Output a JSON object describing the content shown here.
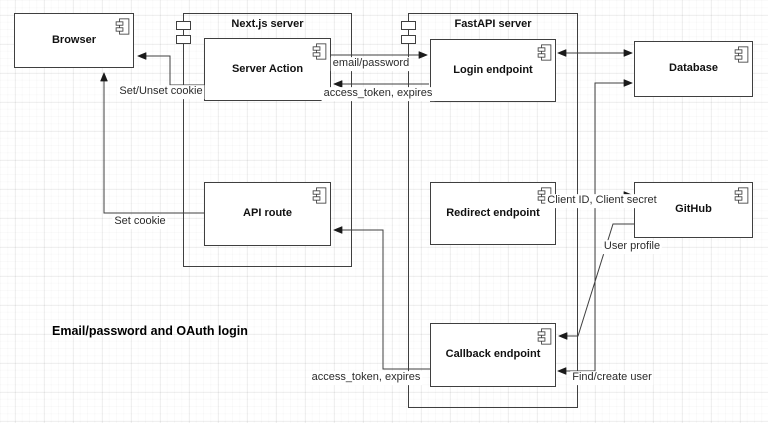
{
  "title": "Email/password and OAuth login",
  "nodes": {
    "browser": {
      "label": "Browser"
    },
    "nextjs_server": {
      "label": "Next.js server"
    },
    "server_action": {
      "label": "Server Action"
    },
    "api_route": {
      "label": "API route"
    },
    "fastapi_server": {
      "label": "FastAPI server"
    },
    "login_endpoint": {
      "label": "Login endpoint"
    },
    "redirect_endpoint": {
      "label": "Redirect endpoint"
    },
    "callback_endpoint": {
      "label": "Callback endpoint"
    },
    "database": {
      "label": "Database"
    },
    "github": {
      "label": "GitHub"
    }
  },
  "edges": {
    "email_password": {
      "label": "email/password"
    },
    "access_token_top": {
      "label": "access_token, expires"
    },
    "set_unset_cookie": {
      "label": "Set/Unset cookie"
    },
    "set_cookie": {
      "label": "Set cookie"
    },
    "client_credentials": {
      "label": "Client ID, Client secret"
    },
    "user_profile": {
      "label": "User profile"
    },
    "find_create_user": {
      "label": "Find/create user"
    },
    "access_token_bottom": {
      "label": "access_token, expires"
    }
  },
  "icons": {
    "component": "uml-component-icon"
  },
  "colors": {
    "stroke": "#3f3f3f",
    "arrow": "#1a1a1a",
    "node_fill": "#ffffff",
    "background": "#ffffff"
  }
}
